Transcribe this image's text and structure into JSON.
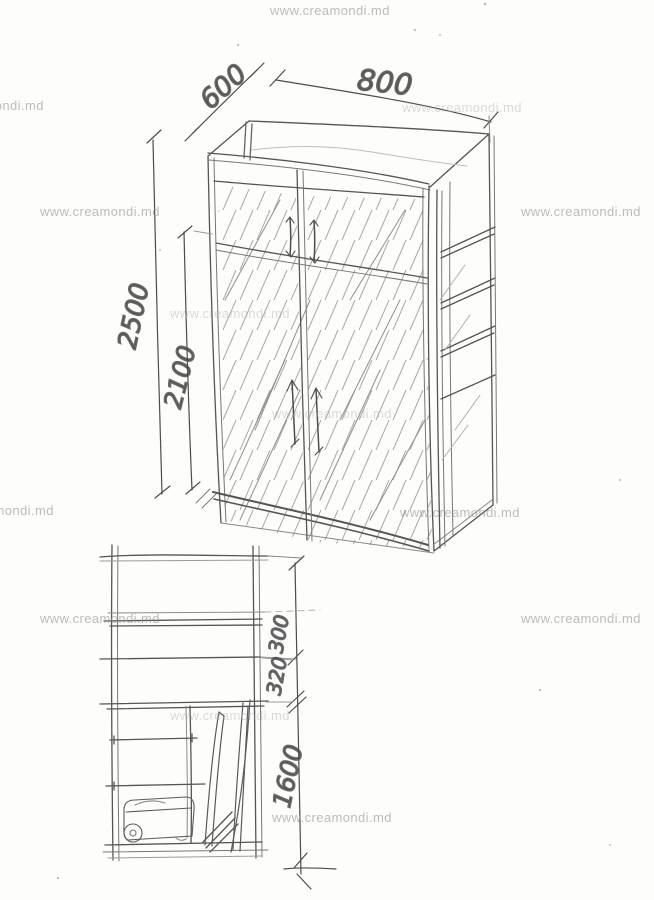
{
  "watermark": {
    "text": "www.creamondi.md"
  },
  "drawing": {
    "type": "hand-drawn furniture sketch",
    "subject": "wardrobe with mezzanine, two mirrored doors, open side shelves and interior section",
    "views": [
      {
        "id": "perspective-view"
      },
      {
        "id": "section-view"
      }
    ]
  },
  "dims": {
    "depth": "600",
    "width": "800",
    "total_height": "2500",
    "door_height": "2100",
    "section_top": "300",
    "section_middle": "320",
    "section_bottom": "1600"
  }
}
